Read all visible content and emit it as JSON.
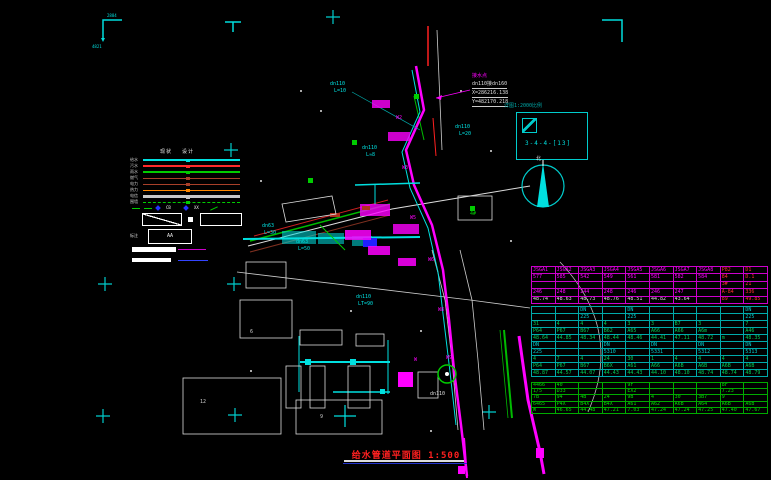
{
  "frame": {
    "tl_text": "2884",
    "tl_text2": "4821"
  },
  "legend": {
    "col_headers": [
      "现状",
      "设计"
    ],
    "rows": [
      {
        "label": "给水",
        "color": "#00E0E0",
        "style": "solid",
        "w": 2
      },
      {
        "label": "污水",
        "color": "#FF2A2A",
        "style": "solid",
        "w": 2
      },
      {
        "label": "雨水",
        "color": "#00CC00",
        "style": "solid",
        "w": 2
      },
      {
        "label": "燃气",
        "color": "#A8402A",
        "style": "solid",
        "w": 1
      },
      {
        "label": "电力",
        "color": "#A8402A",
        "style": "solid",
        "w": 1
      },
      {
        "label": "热力",
        "color": "#FF8800",
        "style": "solid",
        "w": 1
      },
      {
        "label": "电信",
        "color": "#C8C8C8",
        "style": "solid",
        "w": 3
      },
      {
        "label": "围墙",
        "color": "#00CC00",
        "style": "dashed",
        "w": 1
      }
    ],
    "marks_row": {
      "t1": "CB",
      "t2": "XX"
    },
    "note_label": "标注",
    "scale_box_label": "AA"
  },
  "note": {
    "title": "接水点",
    "line1": "dn110接dn160",
    "line2": "X=286216.138",
    "line3": "Y=482170.218"
  },
  "detail": {
    "caption": "详图1:2000比例",
    "label": "3-4-4-[13]"
  },
  "north": {
    "label": "北"
  },
  "title": {
    "text": "给水管道平面图",
    "scale": "1:500"
  },
  "drawing": {
    "labels": [
      {
        "x": 330,
        "y": 82,
        "t": "dn110",
        "c": "#00E0E0"
      },
      {
        "x": 334,
        "y": 89,
        "t": "L=10",
        "c": "#00E0E0"
      },
      {
        "x": 455,
        "y": 125,
        "t": "dn110",
        "c": "#00E0E0"
      },
      {
        "x": 459,
        "y": 132,
        "t": "L=20",
        "c": "#00E0E0"
      },
      {
        "x": 362,
        "y": 146,
        "t": "dn110",
        "c": "#00E0E0"
      },
      {
        "x": 366,
        "y": 153,
        "t": "L≈8",
        "c": "#00E0E0"
      },
      {
        "x": 262,
        "y": 224,
        "t": "dn63",
        "c": "#00E0E0"
      },
      {
        "x": 264,
        "y": 231,
        "t": "L=30",
        "c": "#00E0E0"
      },
      {
        "x": 296,
        "y": 240,
        "t": "dn63",
        "c": "#00E0E0"
      },
      {
        "x": 298,
        "y": 247,
        "t": "L=50",
        "c": "#00E0E0"
      },
      {
        "x": 356,
        "y": 295,
        "t": "dn110",
        "c": "#00E0E0"
      },
      {
        "x": 358,
        "y": 302,
        "t": "LT=90",
        "c": "#00E0E0"
      },
      {
        "x": 430,
        "y": 392,
        "t": "dn110",
        "c": "#DDDDDD"
      },
      {
        "x": 470,
        "y": 212,
        "t": "4#",
        "c": "#00CC00"
      },
      {
        "x": 414,
        "y": 358,
        "t": "W",
        "c": "#FF00FF"
      },
      {
        "x": 396,
        "y": 116,
        "t": "W2",
        "c": "#FF00FF"
      },
      {
        "x": 402,
        "y": 166,
        "t": "W3",
        "c": "#FF00FF"
      },
      {
        "x": 410,
        "y": 216,
        "t": "W5",
        "c": "#FF00FF"
      },
      {
        "x": 428,
        "y": 258,
        "t": "W6",
        "c": "#FF00FF"
      },
      {
        "x": 438,
        "y": 308,
        "t": "W8",
        "c": "#FF00FF"
      },
      {
        "x": 446,
        "y": 356,
        "t": "W9",
        "c": "#FF00FF"
      },
      {
        "x": 250,
        "y": 330,
        "t": "6",
        "c": "#CCCCCC"
      },
      {
        "x": 200,
        "y": 400,
        "t": "12",
        "c": "#CCCCCC"
      },
      {
        "x": 320,
        "y": 415,
        "t": "9",
        "c": "#CCCCCC"
      }
    ]
  },
  "tables": {
    "sections": [
      {
        "id": "tableA",
        "grid": "#CC00CC",
        "text": "#FF00FF",
        "red_cols": [
          8,
          9
        ],
        "red_color": "#FF3030",
        "white_rows": [
          4
        ],
        "rows": [
          [
            "JSGA1",
            "JSGA2",
            "JSGA3",
            "JSGA4",
            "JSGA5",
            "JSGA6",
            "JSGA7",
            "JSGA8",
            "P82",
            "D1"
          ],
          [
            "577",
            "585",
            "542",
            "549",
            "561",
            "581",
            "582",
            "584",
            "84",
            "D.1"
          ],
          [
            "",
            "",
            "",
            "",
            "",
            "",
            "",
            "",
            "3#",
            "21"
          ],
          [
            "246",
            "248",
            "244",
            "248",
            "246",
            "246",
            "247",
            "",
            "A-84",
            "336"
          ],
          [
            "48.74",
            "48.63",
            "48.73",
            "48.76",
            "48.51",
            "44.82",
            "43.64",
            "",
            "89",
            "49.85"
          ]
        ]
      },
      {
        "id": "tableB",
        "grid": "#00AAAA",
        "text": "#00CC55",
        "cyan_rows": [
          0,
          1,
          5,
          6
        ],
        "cyan_color": "#00CCCC",
        "rows": [
          [
            "",
            "",
            "DN",
            "",
            "DN",
            "",
            "",
            "",
            "",
            "DN"
          ],
          [
            "",
            "",
            "225",
            "",
            "225",
            "",
            "",
            "",
            "",
            "225"
          ],
          [
            "31",
            "4",
            "4",
            "4",
            "3",
            "3",
            "B7",
            "3",
            "",
            "7"
          ],
          [
            "P64",
            "P67",
            "B67",
            "B62",
            "A65",
            "A66",
            "A66",
            "A6m",
            "",
            "A46"
          ],
          [
            "48.64",
            "44.85",
            "48.34",
            "48.44",
            "48.46",
            "44.41",
            "47.11",
            "48.72",
            "m",
            "48.35"
          ],
          [
            "DN",
            "",
            "",
            "DN",
            "",
            "DN",
            "",
            "DN",
            "",
            "DN"
          ],
          [
            "225",
            "",
            "",
            "5310",
            "",
            "5331",
            "",
            "5312",
            "",
            "5313"
          ],
          [
            "4",
            "7",
            "4",
            "24",
            "30",
            "1",
            "4",
            "4",
            "4",
            "4"
          ],
          [
            "P64",
            "P67",
            "B67",
            "B6X",
            "A61",
            "A66",
            "A6B",
            "A6B",
            "A6B",
            "A6B"
          ],
          [
            "48.87",
            "44.57",
            "44.07",
            "44.43",
            "44.43",
            "44.10",
            "48.10",
            "48.74",
            "48.74",
            "48.79"
          ]
        ]
      },
      {
        "id": "tableC",
        "grid": "#00AA00",
        "text": "#00DD00",
        "rows": [
          [
            "4466",
            "40",
            "",
            "",
            "9F",
            "",
            "",
            "",
            "8F",
            ""
          ],
          [
            "1/5",
            "D33",
            "",
            "",
            "EX2",
            "",
            "",
            "",
            "7.23",
            ""
          ],
          [
            "7B",
            "94",
            "4B",
            "24",
            "9B",
            "4",
            "30",
            "3B7",
            "9",
            ""
          ],
          [
            "6465",
            "P4X",
            "B4X",
            "B4X",
            "A61",
            "A62",
            "A6B",
            "A64",
            "A6B",
            "A6B"
          ],
          [
            "W",
            "46.65",
            "44.48",
            "47.21",
            "7.03",
            "47.24",
            "47.24",
            "47.25",
            "47.40",
            "47.67"
          ]
        ]
      }
    ]
  }
}
